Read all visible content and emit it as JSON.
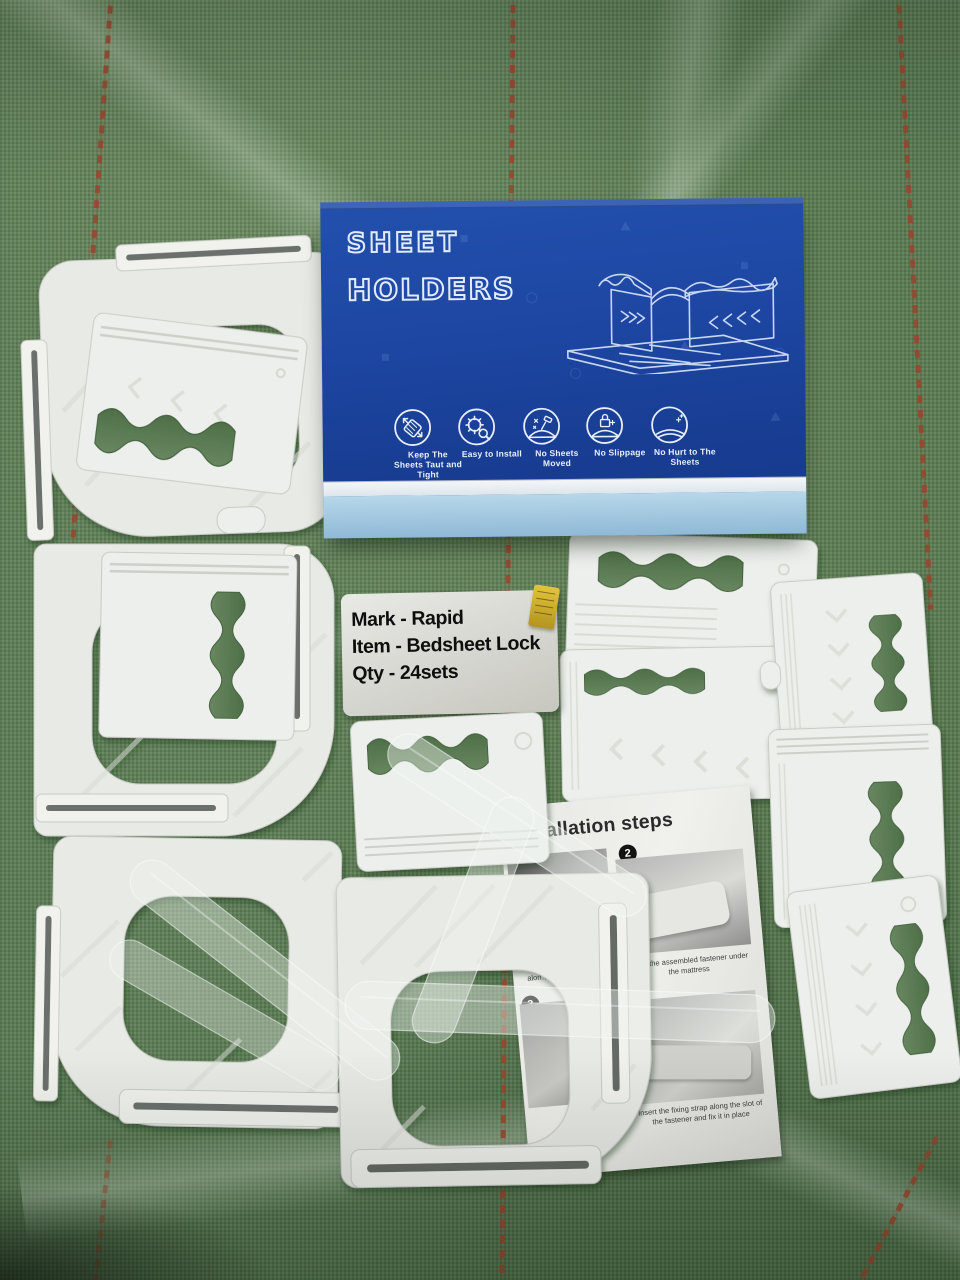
{
  "photo": {
    "subject": "bedsheet holder product kit on green woven tarp",
    "colors": {
      "tarp_green": "#5b7c55",
      "box_blue": "#1d45a1",
      "box_stripe_light_blue": "#a9cce3",
      "plastic_white": "#eceeea",
      "red_tarp_stripe": "#99442c",
      "leaflet_paper": "#ebebe8"
    }
  },
  "box": {
    "title_line1": "SHEET",
    "title_line2": "HOLDERS",
    "illustration": "assembled-sheet-holder-line-art",
    "features": [
      {
        "icon": "sheet-stretch-icon",
        "label": "Keep The Sheets Taut and Tight"
      },
      {
        "icon": "gear-install-icon",
        "label": "Easy to Install"
      },
      {
        "icon": "no-sheets-moved-icon",
        "label": "No Sheets Moved"
      },
      {
        "icon": "no-slippage-lock-icon",
        "label": "No Slippage"
      },
      {
        "icon": "no-hurt-sheets-icon",
        "label": "No Hurt to The Sheets"
      }
    ]
  },
  "shipping_label": {
    "lines": [
      "Mark - Rapid",
      "Item - Bedsheet Lock",
      "Qty - 24sets"
    ],
    "sticker": "yellow-tag"
  },
  "leaflet": {
    "title": "Installation steps",
    "steps": [
      {
        "num": "1",
        "caption": "Ins…\ninto…\nalon…"
      },
      {
        "num": "2",
        "caption": "Insert the assembled fastener under the mattress"
      },
      {
        "num": "3",
        "caption": ""
      },
      {
        "num": "4",
        "caption": "Insert the fixing strap along the slot of the fastener and fix it in place"
      }
    ]
  }
}
